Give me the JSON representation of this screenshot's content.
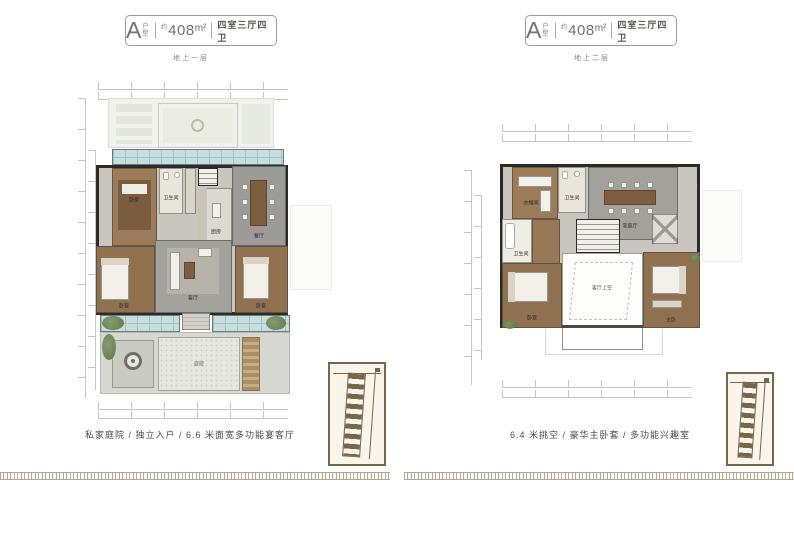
{
  "panels": [
    {
      "header": {
        "unit_letter": "A",
        "unit_label": "户型",
        "approx": "约",
        "area": "408",
        "area_unit": "m²",
        "spec": "四室三厅四卫"
      },
      "floor_label": "地上一层",
      "caption": "私家庭院 / 独立入户 / 6.6 米面宽多功能宴客厅",
      "rooms": {
        "bedroom_top": "卧室",
        "bath_top": "卫生间",
        "kitchen": "厨房",
        "dining": "餐厅",
        "living": "客厅",
        "bedroom_left": "卧室",
        "bedroom_right": "卧室",
        "courtyard": "庭院"
      }
    },
    {
      "header": {
        "unit_letter": "A",
        "unit_label": "户型",
        "approx": "约",
        "area": "408",
        "area_unit": "m²",
        "spec": "四室三厅四卫"
      },
      "floor_label": "地上二层",
      "caption": "6.4 米挑空 / 豪华主卧套 / 多功能兴趣室",
      "rooms": {
        "cloak": "衣帽间",
        "bath_top": "卫生间",
        "family": "家庭厅",
        "bath_left": "卫生间",
        "bedroom_left": "卧室",
        "bedroom_right": "主卧",
        "void_label": "客厅上空"
      }
    }
  ],
  "colors": {
    "wall": "#2c2a26",
    "wood_floor": "#9b7b58",
    "wood_floor_dark": "#8f7150",
    "gray_floor": "#a4a29c",
    "tile": "#e9e5da",
    "glass": "#c6dedd",
    "plant": "#6d8757",
    "courtyard_paving": "#d8d8d3",
    "sitemap_sepia": "#77664a",
    "fret_band": "#b3a78b",
    "dim_line": "#c6c6c2",
    "header_text": "#72726e"
  }
}
